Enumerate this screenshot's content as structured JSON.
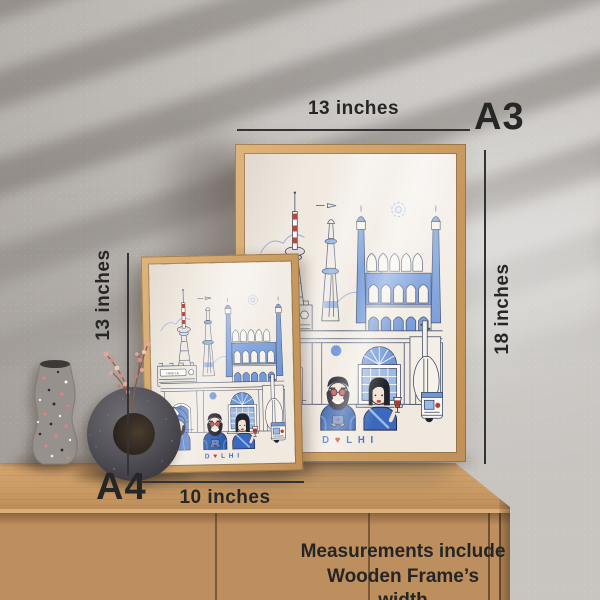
{
  "annotations": {
    "a3_size_label": "A3",
    "a3_width": "13 inches",
    "a3_height": "18 inches",
    "a4_size_label": "A4",
    "a4_height": "13 inches",
    "a4_width": "10 inches",
    "note_line1": "Measurements include",
    "note_line2": "Wooden Frame’s width"
  },
  "poster": {
    "title": "DELHI",
    "title_parts": {
      "left": "D",
      "heart": "♥",
      "right": "LHI"
    },
    "india_label": "INDIA"
  },
  "colors": {
    "wall": "#c3bfbb",
    "cabinet_wood": "#bd8e5e",
    "frame_wood": "#cfa064",
    "poster_background": "#f0e9e0",
    "illustration_blue": "#5d88d3",
    "illustration_navy": "#2f5cab",
    "accent_red": "#c0392b",
    "annotation_ink": "#262626"
  }
}
